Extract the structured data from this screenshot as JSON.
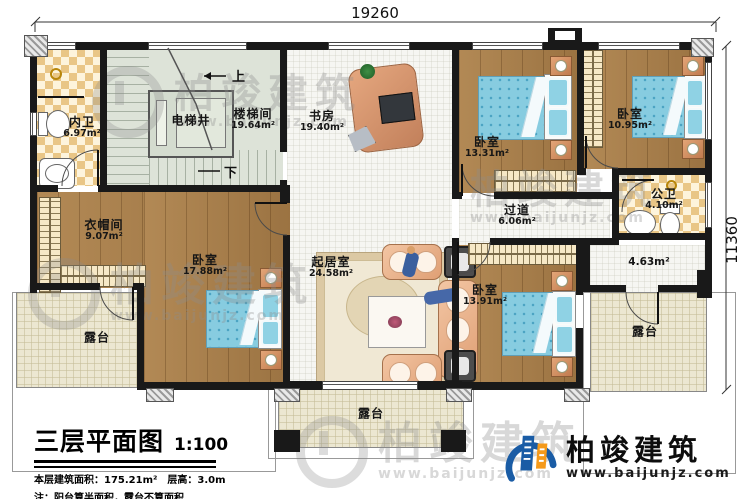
{
  "dimensions": {
    "width_label": "19260",
    "height_label": "11360"
  },
  "stairs": {
    "up": "上",
    "down": "下"
  },
  "rooms": {
    "inner_bath": {
      "name": "内卫",
      "area": "6.97m²"
    },
    "elevator": {
      "name": "电梯井"
    },
    "stairwell": {
      "name": "楼梯间",
      "area": "19.64m²"
    },
    "study": {
      "name": "书房",
      "area": "19.40m²"
    },
    "bedroom_top": {
      "name": "卧室",
      "area": "13.31m²"
    },
    "bedroom_right": {
      "name": "卧室",
      "area": "10.95m²"
    },
    "public_bath": {
      "name": "公卫",
      "area": "4.10m²"
    },
    "hallway": {
      "name": "过道",
      "area": "6.06m²"
    },
    "cloakroom": {
      "name": "衣帽间",
      "area": "9.07m²"
    },
    "bedroom_left": {
      "name": "卧室",
      "area": "17.88m²"
    },
    "living": {
      "name": "起居室",
      "area": "24.58m²"
    },
    "bedroom_bottom": {
      "name": "卧室",
      "area": "13.91m²"
    },
    "small_area": {
      "area": "4.63m²"
    },
    "terrace_left": {
      "name": "露台"
    },
    "terrace_bottom": {
      "name": "露台"
    },
    "terrace_right": {
      "name": "露台"
    }
  },
  "title_block": {
    "title": "三层平面图",
    "scale": "1:100",
    "area_line": "本层建筑面积：175.21m²　层高：3.0m",
    "note_line": "注：阳台算半面积，露台不算面积"
  },
  "brand": {
    "name": "柏竣建筑",
    "website": "www.baijunjz.com"
  },
  "watermark": {
    "name": "柏竣建筑",
    "website": "www.baijunjz.com"
  },
  "colors": {
    "wall": "#191919",
    "wood": "#a9814f",
    "tile": "#e9c686",
    "terrace": "#ece7d1",
    "stair": "#dde3d8",
    "brand_blue": "#1a5ca5",
    "brand_orange": "#f59a1b"
  }
}
